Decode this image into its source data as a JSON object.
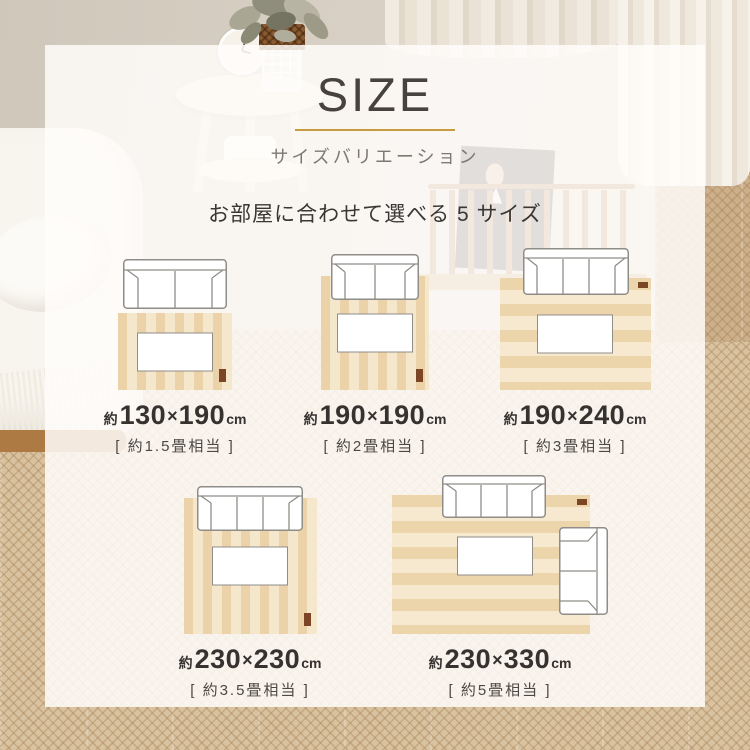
{
  "header": {
    "title": "SIZE",
    "subtitle": "サイズバリエーション",
    "heading": "お部屋に合わせて選べる 5 サイズ"
  },
  "accent_color": "#c79b40",
  "rug": {
    "stripe_dark": "#ecd2a8",
    "stripe_light": "#f5e7cb",
    "tag_color": "#7c4526"
  },
  "sizes": [
    {
      "approx": "約",
      "width": "130",
      "times": "×",
      "depth": "190",
      "unit": "cm",
      "tatami": "[ 約1.5畳相当 ]"
    },
    {
      "approx": "約",
      "width": "190",
      "times": "×",
      "depth": "190",
      "unit": "cm",
      "tatami": "[ 約2畳相当 ]"
    },
    {
      "approx": "約",
      "width": "190",
      "times": "×",
      "depth": "240",
      "unit": "cm",
      "tatami": "[ 約3畳相当 ]"
    },
    {
      "approx": "約",
      "width": "230",
      "times": "×",
      "depth": "230",
      "unit": "cm",
      "tatami": "[ 約3.5畳相当 ]"
    },
    {
      "approx": "約",
      "width": "230",
      "times": "×",
      "depth": "330",
      "unit": "cm",
      "tatami": "[ 約5畳相当 ]"
    }
  ]
}
